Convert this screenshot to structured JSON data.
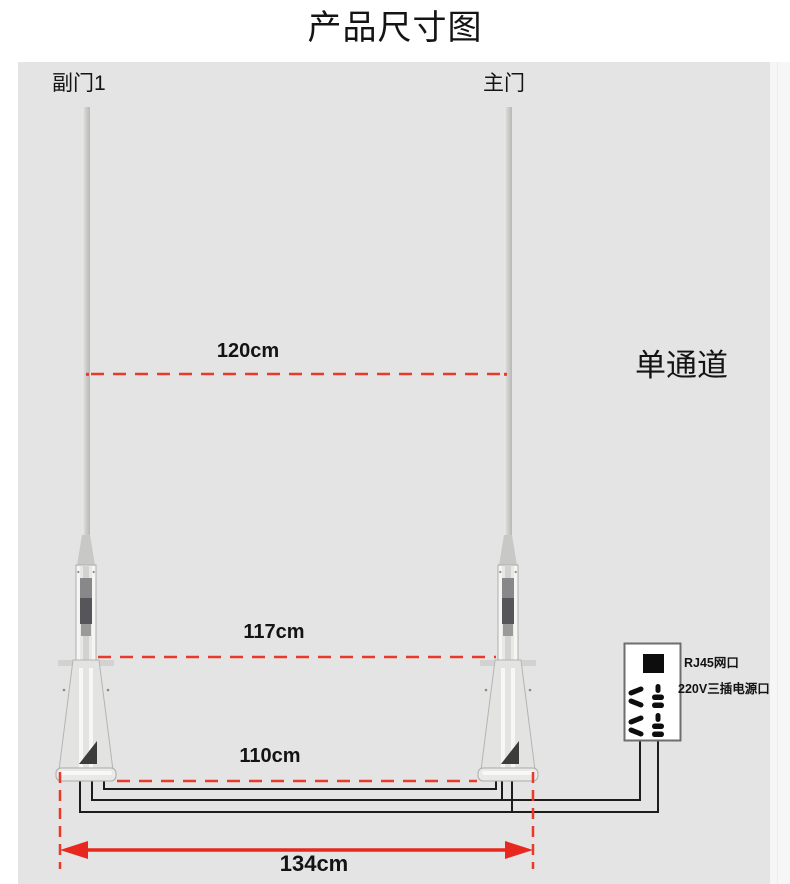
{
  "title": "产品尺寸图",
  "gates": {
    "left_label": "副门1",
    "right_label": "主门"
  },
  "channel_label": "单通道",
  "dimensions": {
    "upper": "120cm",
    "middle": "117cm",
    "lower": "110cm",
    "overall": "134cm"
  },
  "outlet_panel": {
    "rj45_label": "RJ45网口",
    "power_label": "220V三插电源口"
  },
  "icons": {
    "rj45_port": "rj45-port-icon",
    "power_socket": "three-prong-socket-icon"
  },
  "colors": {
    "diagram_bg": "#e4e4e4",
    "dimension_red": "#e8392b",
    "arrow_red": "#e8281e",
    "wire_black": "#1c1c1c",
    "post_gray": "#d9d9d7"
  }
}
